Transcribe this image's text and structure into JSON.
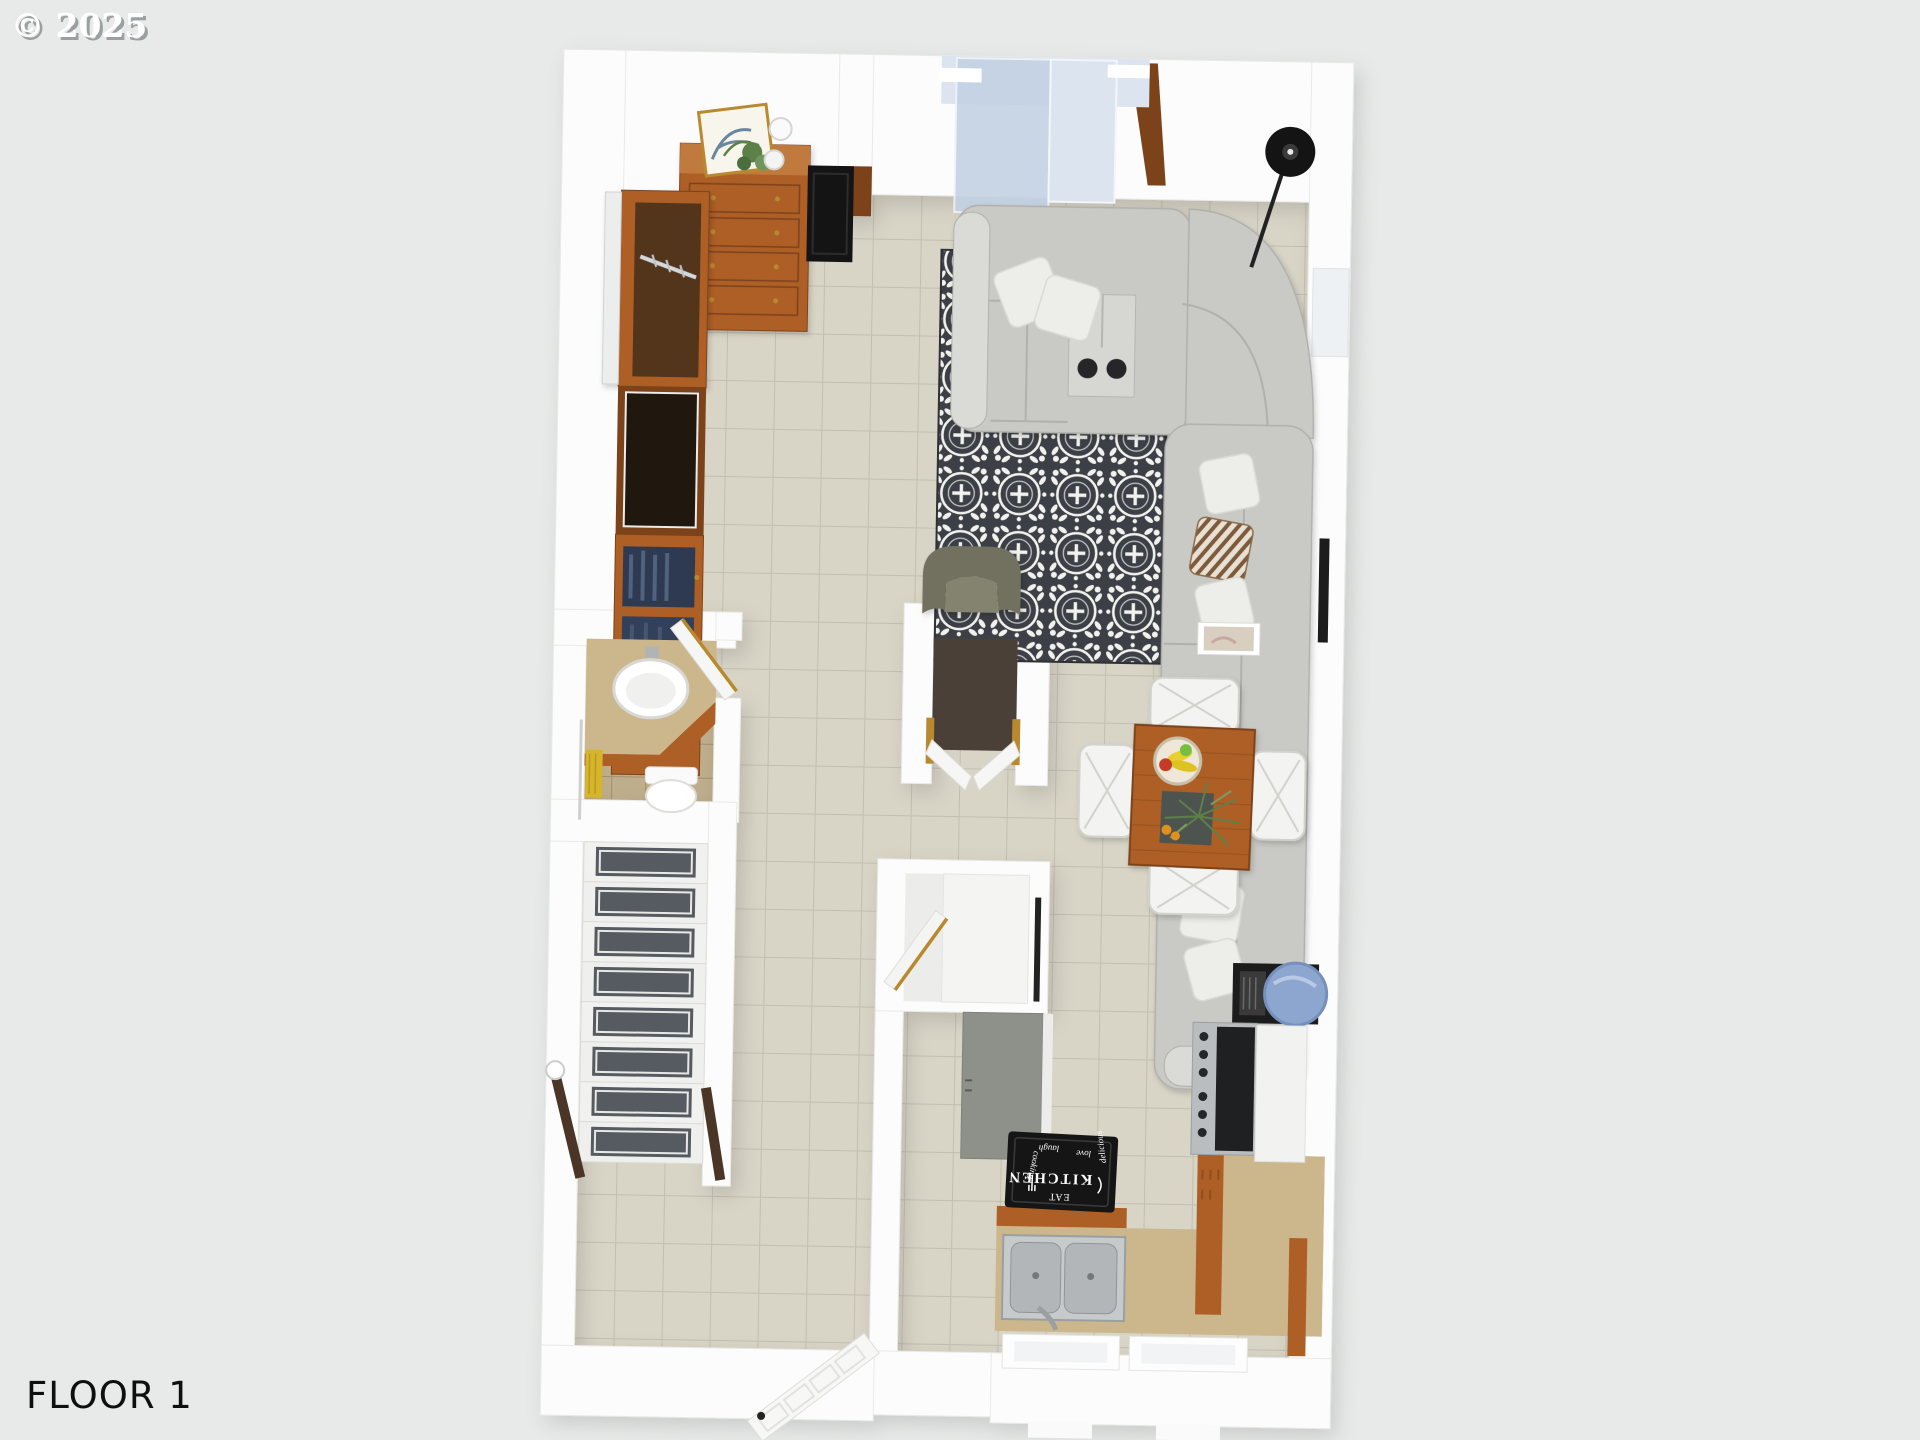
{
  "watermark": {
    "text": "© 2025"
  },
  "floor_label": "FLOOR 1",
  "kitchen_mat": {
    "words": [
      "KITCHEN",
      "EAT",
      "cooking",
      "delicious",
      "love",
      "laugh"
    ]
  },
  "colors": {
    "bg": "#e8eae9",
    "wall": "#fcfcfc",
    "wallEdge": "#e9e9e7",
    "tile": "#d8d4c6",
    "grout": "#c2beb0",
    "bathTile": "#bfae8c",
    "bathGrout": "#a3906c",
    "rugDark": "#3c4046",
    "rugWhite": "#f1f1ee",
    "wood": "#ad5f26",
    "woodDark": "#7c431a",
    "woodLight": "#c07a3c",
    "sofa": "#c9c9c5",
    "sofaShade": "#b0b0ac",
    "sofaLight": "#dadad6",
    "pillow": "#ededea",
    "olive": "#72715f",
    "counter": "#ccb78c",
    "grayDoor": "#8d918a",
    "runner": "#565b61",
    "stainless": "#b9bdbf",
    "applianceBlack": "#1e2022",
    "glass": "#c3d2e4",
    "glassLight": "#dce5ef",
    "gold": "#b9892f",
    "towel": "#d6b52c",
    "bowlBlue": "#8da6cf",
    "frameBlack": "#1c1c1c",
    "matBlack": "#151515",
    "green": "#5c8047",
    "banana": "#e6cf2f",
    "appleRed": "#c63a28",
    "appleGreen": "#74bf3f",
    "orange": "#e2901f",
    "chairWhite": "#f3f3f1",
    "text": "#0f0f0f",
    "watermark": "#ffffff",
    "watermarkShadow": "#9aa0a0"
  }
}
